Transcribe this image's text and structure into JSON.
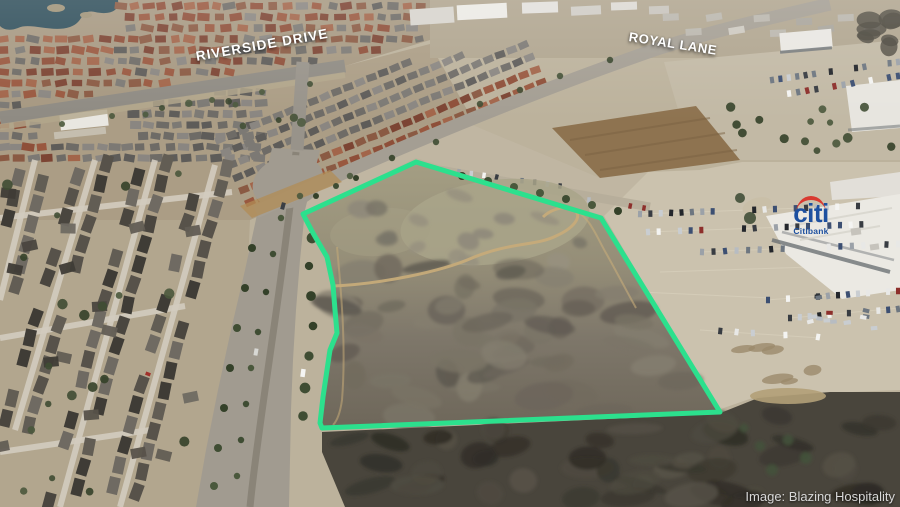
{
  "road_labels": {
    "riverside_drive": "RIVERSIDE DRIVE",
    "royal_lane": "ROYAL LANE"
  },
  "branding": {
    "citi_wordmark": "citi",
    "citibank_label": "Citibank",
    "citi_blue": "#1d50a0",
    "citi_red": "#d93a30"
  },
  "credit": {
    "text": "Image: Blazing Hospitality"
  },
  "annotations": {
    "parcel_outline": {
      "color": "#2ce08d",
      "stroke_width": 5,
      "points": "416,162 601,218 720,412 322,428 320,423 323,397 327,370 330,350 337,333 335,310 333,285 327,257 313,233 303,214"
    }
  }
}
